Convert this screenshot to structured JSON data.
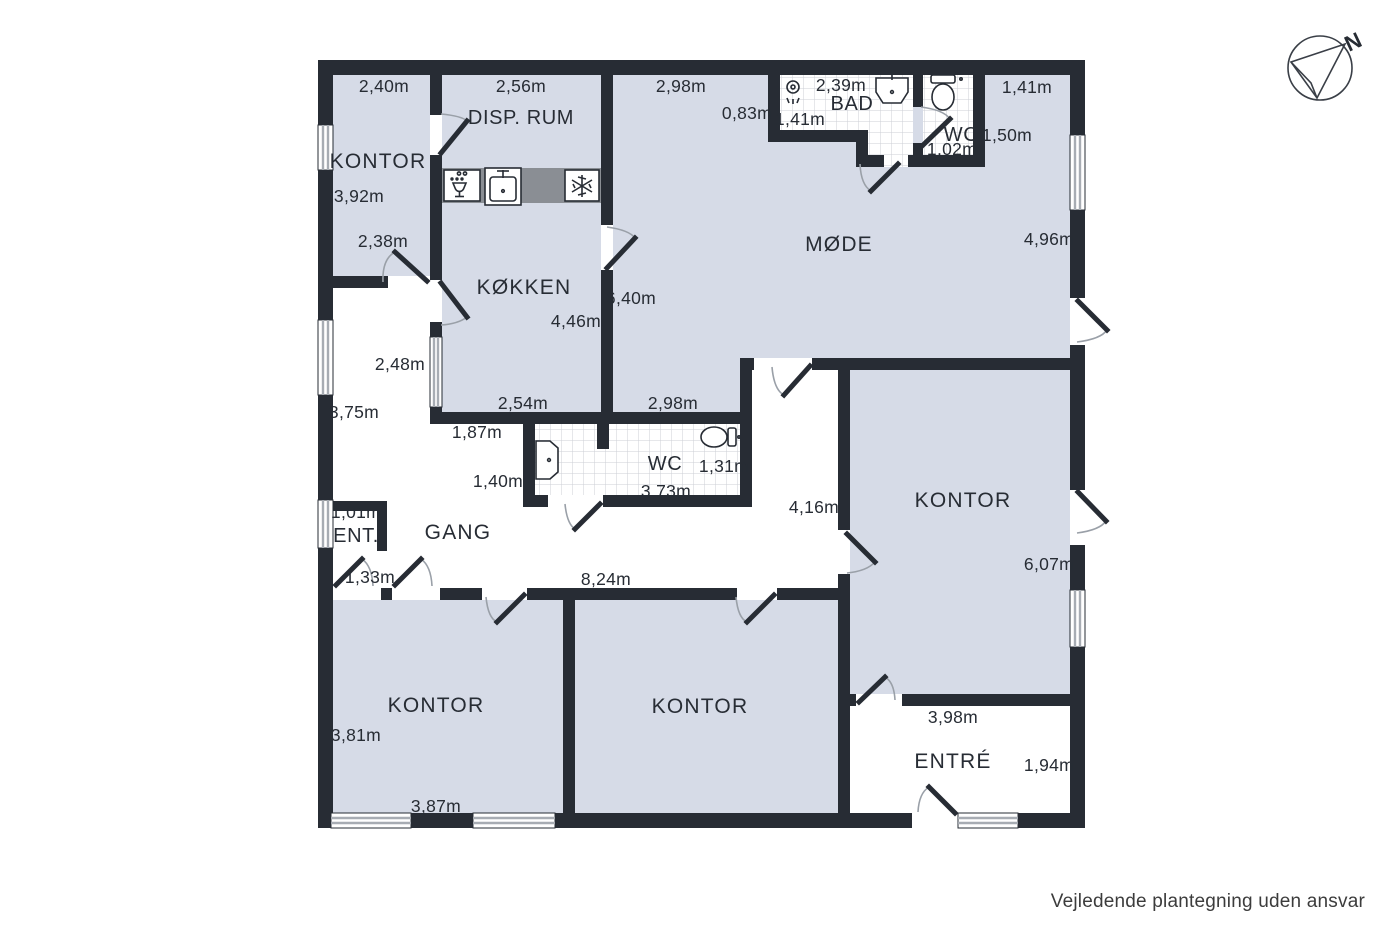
{
  "meta": {
    "footer": "Vejledende plantegning uden ansvar",
    "compass_north": "N"
  },
  "colors": {
    "wall": "#272C34",
    "ink": "#272C34",
    "room_fill": "#D6DBE7",
    "counter": "#8A8E94",
    "tile_line": "#CCCFD6",
    "arc": "#9AA0A8",
    "window_line": "#A7ACB3"
  },
  "rooms": [
    {
      "id": "kontor_top_left",
      "label": "KONTOR"
    },
    {
      "id": "disp_rum",
      "label": "DISP. RUM"
    },
    {
      "id": "koekken",
      "label": "KØKKEN"
    },
    {
      "id": "moede",
      "label": "MØDE"
    },
    {
      "id": "bad",
      "label": "BAD"
    },
    {
      "id": "wc_top",
      "label": "WC"
    },
    {
      "id": "wc_mid",
      "label": "WC"
    },
    {
      "id": "gang",
      "label": "GANG"
    },
    {
      "id": "ent",
      "label": "ENT."
    },
    {
      "id": "kontor_right",
      "label": "KONTOR"
    },
    {
      "id": "kontor_bottom_left",
      "label": "KONTOR"
    },
    {
      "id": "kontor_bottom_mid",
      "label": "KONTOR"
    },
    {
      "id": "entre",
      "label": "ENTRÉ"
    }
  ],
  "labels": {
    "kontor_tl_name": "KONTOR",
    "kontor_tl_width": "2,40m",
    "kontor_tl_height": "3,92m",
    "kontor_tl_door": "2,38m",
    "disp_rum_name": "DISP. RUM",
    "disp_rum_width": "2,56m",
    "koekken_name": "KØKKEN",
    "koekken_width": "4,46m",
    "koekken_bottom": "2,54m",
    "moede_name": "MØDE",
    "moede_width_top": "2,98m",
    "moede_height_right": "4,96m",
    "moede_height_left": "6,40m",
    "moede_bottom": "2,98m",
    "moede_right_strip": "1,41m",
    "bad_name": "BAD",
    "bad_width": "2,39m",
    "bad_offset": "0,83m",
    "bad_inner": "1,41m",
    "wc_top_name": "WC",
    "wc_top_height": "1,50m",
    "wc_top_width": "1,02m",
    "wc_mid_name": "WC",
    "wc_mid_height": "1,31m",
    "wc_mid_width": "3,73m",
    "gang_name": "GANG",
    "gang_width_top": "2,48m",
    "gang_height_left": "3,75m",
    "gang_offset": "1,87m",
    "gang_width_mid": "1,40m",
    "gang_length": "8,24m",
    "corridor_width": "4,16m",
    "ent_name": "ENT.",
    "ent_width": "1,01m",
    "ent_depth": "1,33m",
    "kontor_right_name": "KONTOR",
    "kontor_right_height": "6,07m",
    "kontor_bl_name": "KONTOR",
    "kontor_bl_height": "3,81m",
    "kontor_bl_width": "3,87m",
    "kontor_bm_name": "KONTOR",
    "entre_name": "ENTRÉ",
    "entre_width": "3,98m",
    "entre_height": "1,94m"
  },
  "icons": [
    "compass-icon",
    "shower-icon",
    "bath-sink-icon",
    "toilet-icon",
    "kitchen-sink-icon",
    "dishwasher-icon",
    "freezer-icon"
  ]
}
